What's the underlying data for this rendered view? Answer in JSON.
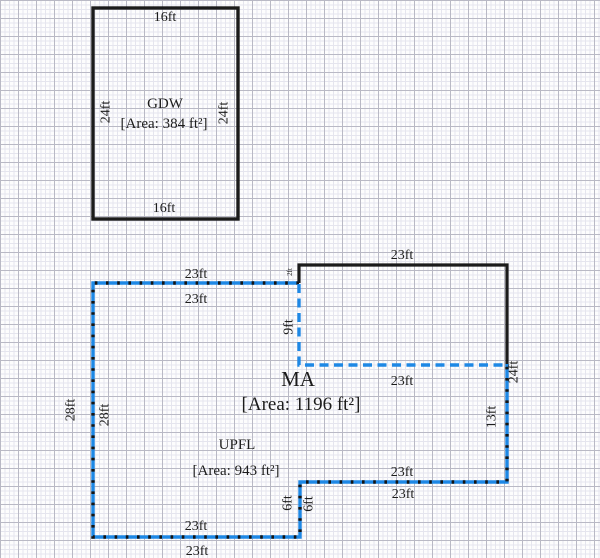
{
  "canvas": {
    "width": 600,
    "height": 558
  },
  "colors": {
    "wall_black": "#1b1b1b",
    "shared_blue": "#1e88e5",
    "grid_minor": "#e5e5ee",
    "grid_major": "#b9b9c5",
    "background": "#fdfdfd",
    "text": "#1c1c1c"
  },
  "rooms": {
    "gdw": {
      "name": "GDW",
      "area": "[Area: 384 ft²]"
    },
    "ma": {
      "name": "MA",
      "area": "[Area: 1196 ft²]"
    },
    "upfl": {
      "name": "UPFL",
      "area": "[Area: 943 ft²]"
    }
  },
  "dims": {
    "gdw_top": "16ft",
    "gdw_bottom": "16ft",
    "gdw_left": "24ft",
    "gdw_right": "24ft",
    "ma_top": "23ft",
    "ma_right": "24ft",
    "ma_notch": "2ft",
    "ma_bottom": "23ft",
    "shared_top_outer": "23ft",
    "shared_top_inner": "23ft",
    "upfl_mid_h": "23ft",
    "upfl_mid_v": "9ft",
    "upfl_right": "13ft",
    "upfl_bottom_right": "23ft",
    "step_outer": "6ft",
    "step_inner": "6ft",
    "bottom_inner": "23ft",
    "bottom_outer": "23ft",
    "left_outer": "28ft",
    "left_inner": "28ft"
  }
}
